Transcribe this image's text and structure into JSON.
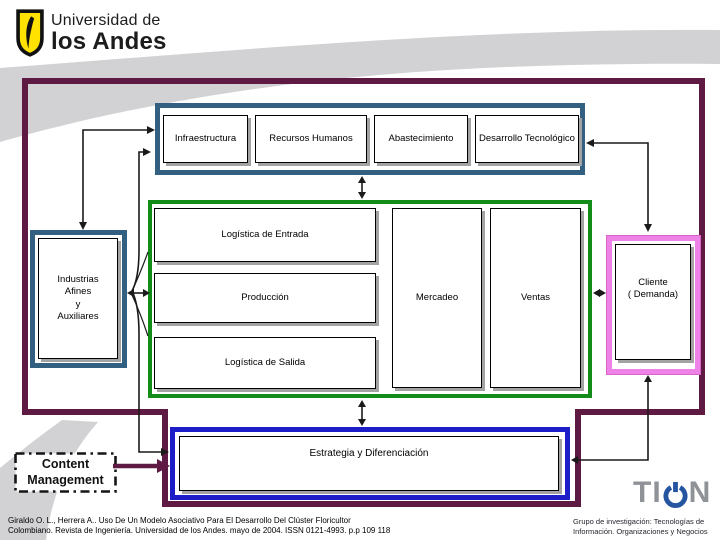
{
  "logo": {
    "line1": "Universidad de",
    "line2": "los Andes"
  },
  "diagram": {
    "support": {
      "boxes": [
        {
          "label": "Infraestructura"
        },
        {
          "label": "Recursos Humanos"
        },
        {
          "label": "Abastecimiento"
        },
        {
          "label": "Desarrollo Tecnológico"
        }
      ]
    },
    "primary": {
      "boxes": [
        {
          "label": "Logística de Entrada"
        },
        {
          "label": "Producción"
        },
        {
          "label": "Logística de Salida"
        },
        {
          "label": "Mercadeo"
        },
        {
          "label": "Ventas"
        }
      ]
    },
    "related_industries": {
      "label": "Industrias\nAfines\ny\nAuxiliares"
    },
    "client": {
      "label": "Cliente\n( Demanda)"
    },
    "strategy": {
      "label": "Estrategia y Diferenciación"
    },
    "content_management": {
      "label": "Content\nManagement"
    }
  },
  "footer": {
    "citation": "Giraldo O. L., Herrera A.. Uso De Un Modelo Asociativo Para El Desarrollo Del Clúster Floricultor\nColombiano. Revista de Ingeniería. Universidad de los Andes. mayo de 2004. ISSN 0121-4993. p.p 109 118",
    "research_group": "Grupo de investigación: Tecnologías de\nInformación. Organizaciones y Negocios",
    "tion_left": "TI",
    "tion_right": "N"
  },
  "colors": {
    "outer_frame_maroon": "#5F1A44",
    "support_frame_blue": "#336080",
    "primary_frame_green": "#148C19",
    "client_frame_pink": "#EE82E6",
    "strategy_frame_blue": "#1E1EC8",
    "swoosh_gray": "#D2D2D5",
    "logo_yellow": "#FFE200",
    "tion_gray": "#8F9296",
    "tion_blue": "#2555A0"
  }
}
